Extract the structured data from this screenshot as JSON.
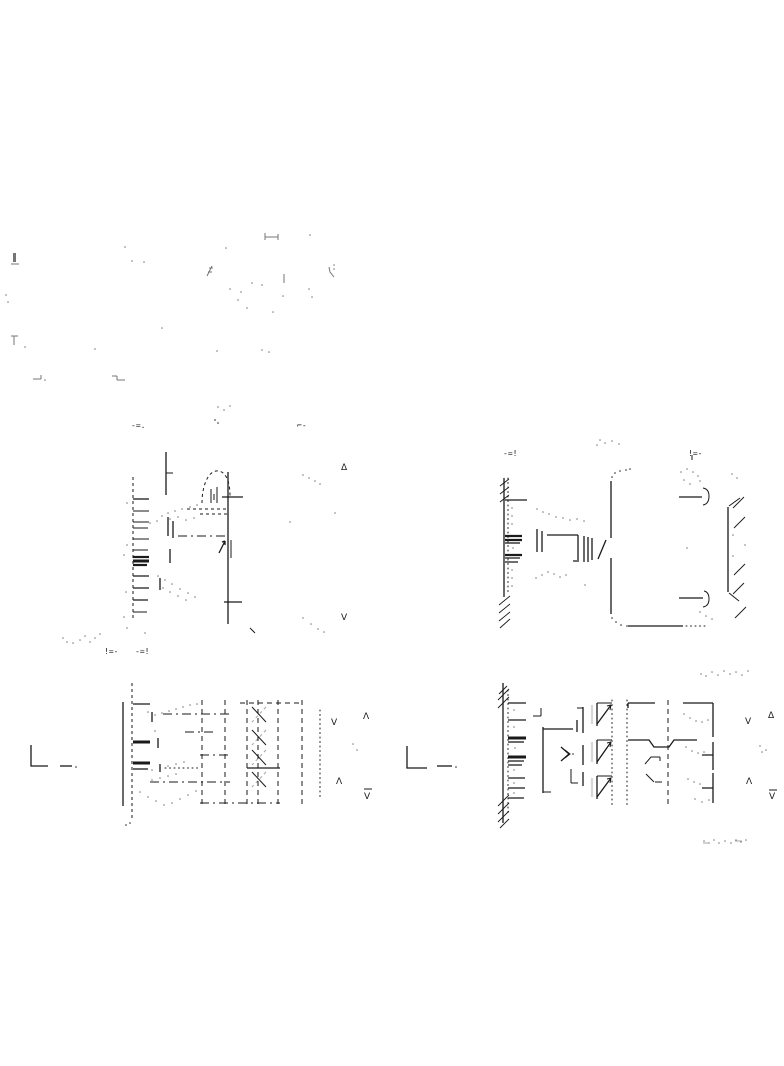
{
  "page": {
    "background": "#ffffff",
    "ink": "#1a1a1a",
    "width": 784,
    "height": 1066
  },
  "marks": {
    "mid_left": {
      "left_label": "-=.",
      "right_label": "⌐-",
      "arrow_up": "Δ",
      "arrow_down": "V"
    },
    "mid_right": {
      "left_label": "-=!",
      "right_label": "!=-"
    },
    "mid_row_pair": {
      "left": "!=-",
      "right": "-=!"
    },
    "bot_left": {
      "arrow_v_inner": "V",
      "arrow_lambda_outer": "Λ",
      "arrow_lambda_inner": "Λ",
      "arrow_v_outer": "V"
    },
    "bot_right": {
      "arrow_v_inner": "V",
      "arrow_delta_outer": "Δ",
      "arrow_lambda_inner": "Λ",
      "arrow_v_outer": "V"
    }
  }
}
